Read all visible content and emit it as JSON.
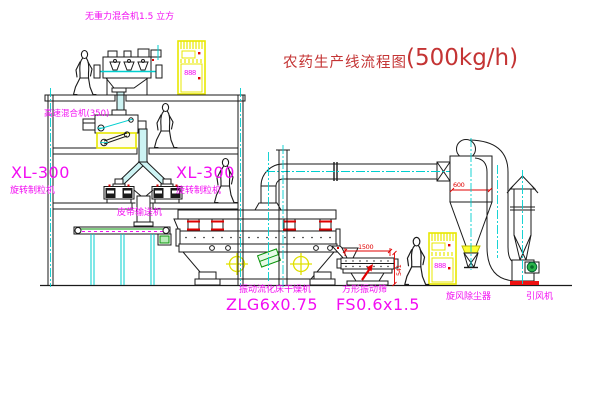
{
  "diagram": {
    "title": "农药生产线流程图",
    "title_capacity": "(500kg/h)",
    "labels": {
      "gravity_mixer": "无重力混合机1.5 立方",
      "high_speed_mixer": "高速混合机(350)",
      "granulator_left_model": "XL-300",
      "granulator_left_name": "旋转制粒机",
      "granulator_right_model": "XL-300",
      "granulator_right_name": "旋转制粒机",
      "belt_conveyor": "皮带输送机",
      "dryer_name": "振动流化床干燥机",
      "dryer_model": "ZLG6x0.75",
      "screen_name": "方形振动筛",
      "screen_model": "FS0.6x1.5",
      "cyclone_name": "旋风除尘器",
      "fan_name": "引风机"
    },
    "dimensions": {
      "screen_length": "1500",
      "screen_height": "541",
      "cyclone_dia": "600"
    },
    "cabinet_displays": {
      "cabinet1": "888",
      "cabinet2": "888"
    },
    "colors": {
      "label_magenta": "#f20df2",
      "title_red": "#c43434",
      "line_black": "#1a1a1a",
      "centerline_cyan": "#00cfcf",
      "duct_fill": "#cdf4f4",
      "highlight_yellow": "#e8e800",
      "dimension_red": "#e00000",
      "accent_green": "#089408"
    }
  }
}
